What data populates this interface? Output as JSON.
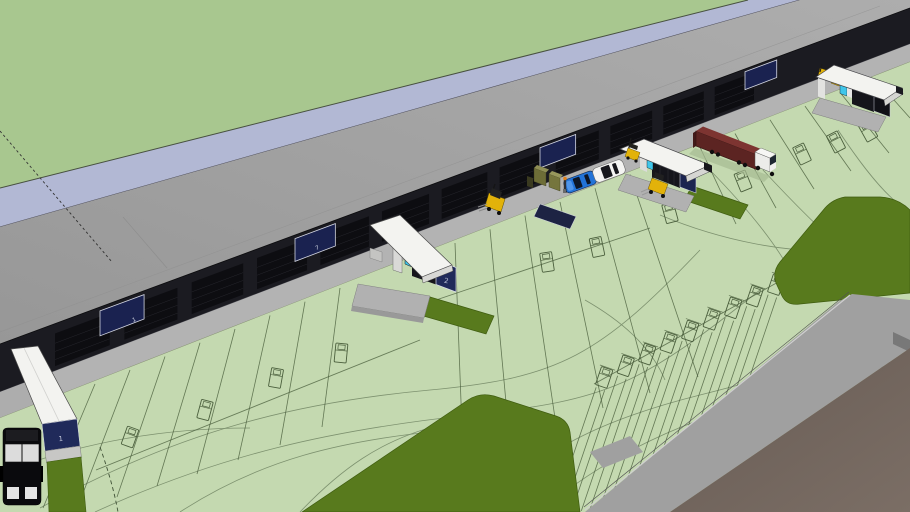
{
  "scene": {
    "type": "3d-model-viewport",
    "description": "3D model of a logistics warehouse: long dark dock facade under a green flat roof, numbered dock canopies, loading apron with cars, forklifts and a semi-trailer truck, light green pavement with dock lanes, swept-path curves, truck parking stalls, olive grass islands and access roads",
    "labels": {
      "gatehouse_1": "1",
      "gatehouse_2": "2",
      "facade_unit_a": "1",
      "facade_unit_b": "7"
    },
    "counts": {
      "dock_doors": 12,
      "navy_panels": 4,
      "gatehouses": 4,
      "parking_stalls": 9
    },
    "colors": {
      "field": "#a8c78f",
      "parapet": "#b2b8d4",
      "roof": "#a3a3a3",
      "facade": "#1b1b21",
      "door": "#0d0d11",
      "panel": "#1a2250",
      "apron": "#b3b3b3",
      "pavement": "#c4d9b0",
      "marking": "#4a5e3c",
      "grass": "#587a1d",
      "grassdark": "#3f5c10",
      "road": "#a0a0a0",
      "dirt": "#6f625b",
      "canopy": "#f3f3f0",
      "cabin": "#15151b",
      "banner": "#202a5a",
      "cyan": "#3fc6ea",
      "forklift": "#e2b20a",
      "trailer": "#5c2422",
      "trailertop": "#7d3431",
      "cab": "#ececea",
      "carblue": "#2273d8",
      "carwhite": "#f4f4f2",
      "van": "#0a0a0d"
    },
    "objects": [
      "warehouse-building",
      "dock-canopies",
      "semi-truck",
      "blue-car",
      "white-car",
      "forklifts",
      "pallet-stacks",
      "worker",
      "black-van",
      "dock-lanes",
      "truck-parking-stalls",
      "swept-path-curves",
      "grass-islands",
      "access-road"
    ]
  }
}
